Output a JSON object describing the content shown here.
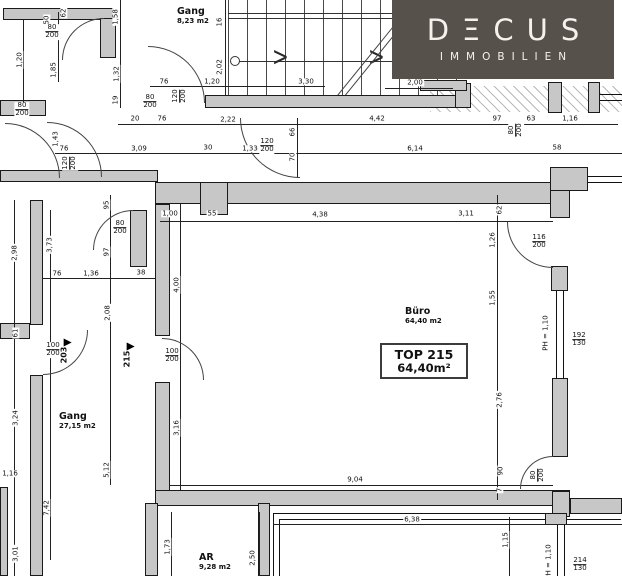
{
  "logo": {
    "title": "DΞCUS",
    "subtitle": "IMMOBILIEN",
    "bg": "#57514b",
    "fg": "#f4f2ef"
  },
  "unit_box": {
    "line1": "TOP 215",
    "line2": "64,40m²"
  },
  "rooms": [
    {
      "name": "Gang",
      "area": "8,23 m2",
      "x": 177,
      "y": 6
    },
    {
      "name": "Büro",
      "area": "64,40 m2",
      "x": 405,
      "y": 306
    },
    {
      "name": "Gang",
      "area": "27,15 m2",
      "x": 59,
      "y": 411
    },
    {
      "name": "AR",
      "area": "9,28 m2",
      "x": 199,
      "y": 552
    }
  ],
  "door_markers": [
    {
      "label": "203",
      "x": 64,
      "y": 352
    },
    {
      "label": "215",
      "x": 127,
      "y": 356
    }
  ],
  "dims": [
    {
      "t": "50",
      "r": 1,
      "x": 47,
      "y": 20
    },
    {
      "t": "62",
      "r": 1,
      "x": 64,
      "y": 13
    },
    {
      "t": "80/200",
      "f": 1,
      "x": 52,
      "y": 32
    },
    {
      "t": "1,20",
      "r": 1,
      "x": 20,
      "y": 60
    },
    {
      "t": "1,85",
      "r": 1,
      "x": 54,
      "y": 70
    },
    {
      "t": "80/200",
      "f": 1,
      "x": 22,
      "y": 110
    },
    {
      "t": "1,58",
      "r": 1,
      "x": 116,
      "y": 17
    },
    {
      "t": "1,32",
      "r": 1,
      "x": 117,
      "y": 74
    },
    {
      "t": "19",
      "r": 1,
      "x": 116,
      "y": 100
    },
    {
      "t": "1,43",
      "r": 1,
      "x": 56,
      "y": 139
    },
    {
      "t": "76",
      "x": 64,
      "y": 149
    },
    {
      "t": "120/200",
      "f": 1,
      "r": 1,
      "x": 70,
      "y": 163
    },
    {
      "t": "3,09",
      "x": 139,
      "y": 149
    },
    {
      "t": "80/200",
      "f": 1,
      "x": 150,
      "y": 102
    },
    {
      "t": "76",
      "x": 164,
      "y": 82
    },
    {
      "t": "120/200",
      "f": 1,
      "r": 1,
      "x": 180,
      "y": 96
    },
    {
      "t": "1,20",
      "x": 212,
      "y": 82
    },
    {
      "t": "3,30",
      "x": 306,
      "y": 82
    },
    {
      "t": "2,00",
      "x": 415,
      "y": 83
    },
    {
      "t": "16",
      "r": 1,
      "x": 220,
      "y": 22
    },
    {
      "t": "2,02",
      "r": 1,
      "x": 220,
      "y": 67
    },
    {
      "t": "20",
      "x": 135,
      "y": 119
    },
    {
      "t": "76",
      "x": 162,
      "y": 119
    },
    {
      "t": "2,22",
      "x": 228,
      "y": 120
    },
    {
      "t": "4,42",
      "x": 377,
      "y": 119
    },
    {
      "t": "97",
      "x": 497,
      "y": 119
    },
    {
      "t": "80/200",
      "f": 1,
      "r": 1,
      "x": 516,
      "y": 130
    },
    {
      "t": "63",
      "x": 531,
      "y": 119
    },
    {
      "t": "1,16",
      "x": 570,
      "y": 119
    },
    {
      "t": "30",
      "x": 208,
      "y": 148
    },
    {
      "t": "1,33",
      "x": 250,
      "y": 149
    },
    {
      "t": "120/200",
      "f": 1,
      "x": 267,
      "y": 146
    },
    {
      "t": "66",
      "r": 1,
      "x": 293,
      "y": 132
    },
    {
      "t": "70",
      "r": 1,
      "x": 293,
      "y": 157
    },
    {
      "t": "6,14",
      "x": 415,
      "y": 149
    },
    {
      "t": "58",
      "x": 557,
      "y": 148
    },
    {
      "t": "1,00",
      "x": 170,
      "y": 214
    },
    {
      "t": "55",
      "x": 212,
      "y": 214
    },
    {
      "t": "4,38",
      "x": 320,
      "y": 215
    },
    {
      "t": "3,11",
      "x": 466,
      "y": 214
    },
    {
      "t": "62",
      "r": 1,
      "x": 500,
      "y": 210
    },
    {
      "t": "1,26",
      "r": 1,
      "x": 493,
      "y": 240
    },
    {
      "t": "116/200",
      "f": 1,
      "x": 539,
      "y": 242
    },
    {
      "t": "1,55",
      "r": 1,
      "x": 493,
      "y": 298
    },
    {
      "t": "PH = 1,10",
      "r": 1,
      "x": 546,
      "y": 333
    },
    {
      "t": "192/130",
      "f": 1,
      "x": 579,
      "y": 340
    },
    {
      "t": "2,76",
      "r": 1,
      "x": 500,
      "y": 400
    },
    {
      "t": "90",
      "r": 1,
      "x": 501,
      "y": 471
    },
    {
      "t": "7",
      "r": 1,
      "x": 500,
      "y": 490
    },
    {
      "t": "80/200",
      "f": 1,
      "r": 1,
      "x": 538,
      "y": 475
    },
    {
      "t": "4,00",
      "r": 1,
      "x": 177,
      "y": 285
    },
    {
      "t": "3,16",
      "r": 1,
      "x": 177,
      "y": 428
    },
    {
      "t": "9,04",
      "x": 355,
      "y": 480
    },
    {
      "t": "95",
      "r": 1,
      "x": 107,
      "y": 205
    },
    {
      "t": "80/200",
      "f": 1,
      "x": 120,
      "y": 228
    },
    {
      "t": "97",
      "r": 1,
      "x": 107,
      "y": 252
    },
    {
      "t": "76",
      "x": 57,
      "y": 274
    },
    {
      "t": "1,36",
      "x": 91,
      "y": 274
    },
    {
      "t": "38",
      "x": 141,
      "y": 273
    },
    {
      "t": "2,98",
      "r": 1,
      "x": 15,
      "y": 253
    },
    {
      "t": "3,73",
      "r": 1,
      "x": 50,
      "y": 245
    },
    {
      "t": "61",
      "r": 1,
      "x": 16,
      "y": 333
    },
    {
      "t": "100/200",
      "f": 1,
      "x": 53,
      "y": 350
    },
    {
      "t": "2,08",
      "r": 1,
      "x": 108,
      "y": 313
    },
    {
      "t": "100/200",
      "f": 1,
      "x": 172,
      "y": 356
    },
    {
      "t": "3,24",
      "r": 1,
      "x": 16,
      "y": 418
    },
    {
      "t": "1,16",
      "x": 10,
      "y": 474
    },
    {
      "t": "5,12",
      "r": 1,
      "x": 107,
      "y": 470
    },
    {
      "t": "7,42",
      "r": 1,
      "x": 47,
      "y": 508
    },
    {
      "t": "3,01",
      "r": 1,
      "x": 16,
      "y": 554
    },
    {
      "t": "1,73",
      "r": 1,
      "x": 168,
      "y": 547
    },
    {
      "t": "2,50",
      "r": 1,
      "x": 253,
      "y": 558
    },
    {
      "t": "6,38",
      "x": 412,
      "y": 520
    },
    {
      "t": "1,15",
      "r": 1,
      "x": 506,
      "y": 540
    },
    {
      "t": "PH = 1,10",
      "r": 1,
      "x": 549,
      "y": 562
    },
    {
      "t": "214/130",
      "f": 1,
      "x": 580,
      "y": 565
    }
  ]
}
